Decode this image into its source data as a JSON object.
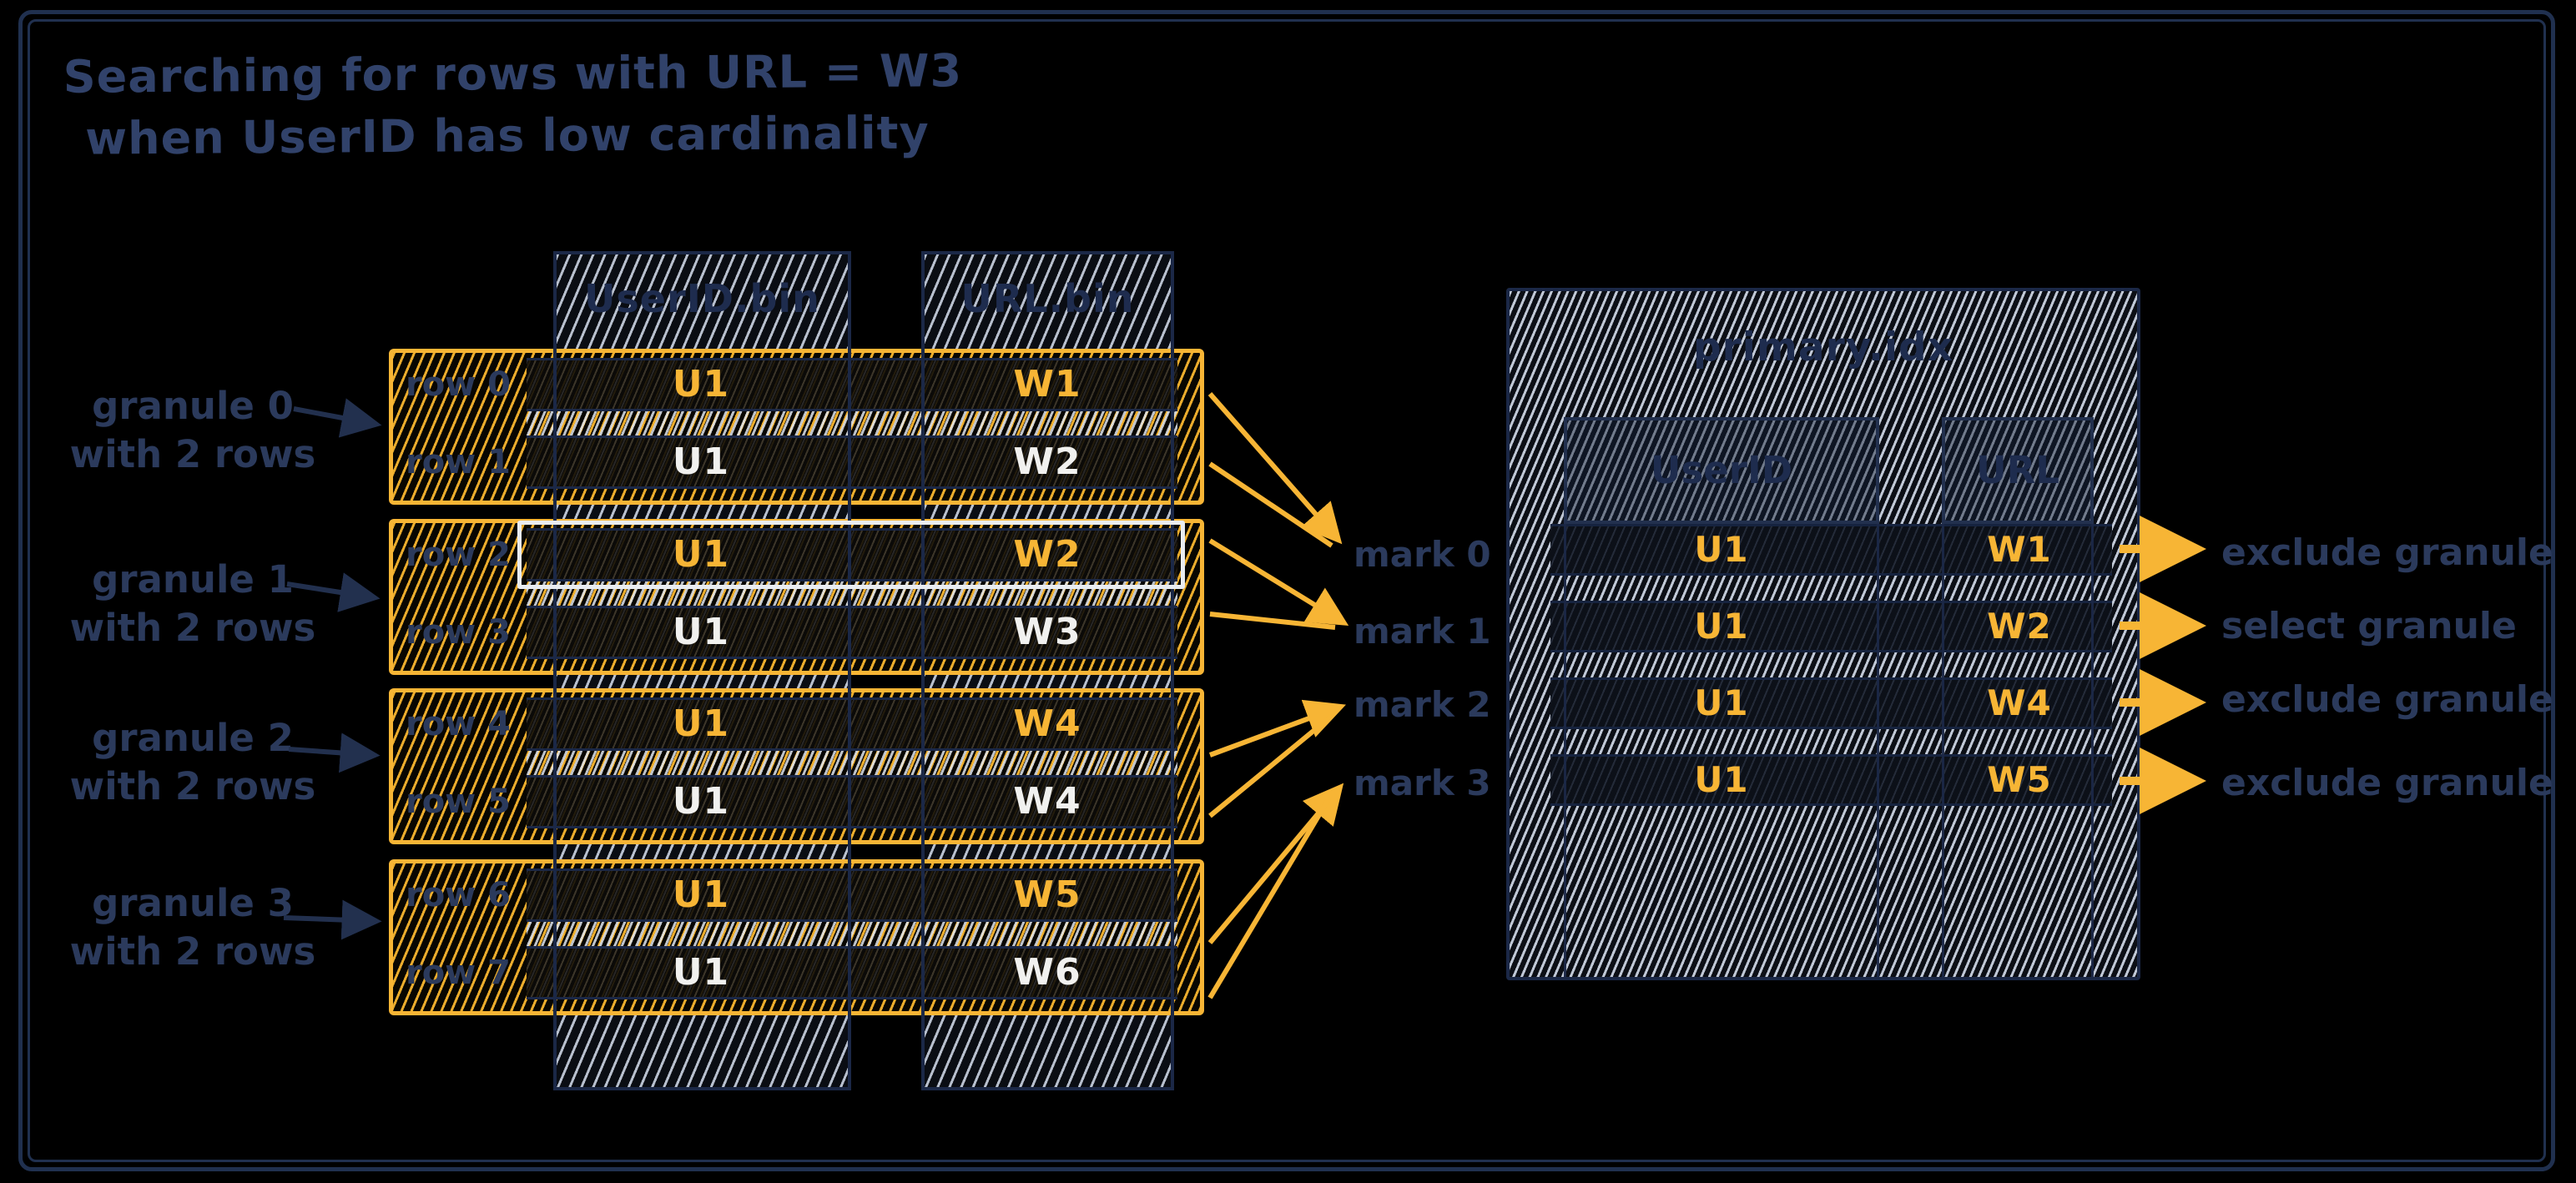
{
  "title": {
    "line1": "Searching for rows with URL = W3",
    "line2": "when UserID has low cardinality"
  },
  "colors": {
    "background": "#000000",
    "ink_navy": "#22304e",
    "accent_orange": "#f7b535",
    "highlight_white": "#e9ecf1",
    "hatch_light": "#cbd3e2"
  },
  "column_files": {
    "userid_header": "UserID.bin",
    "url_header": "URL.bin"
  },
  "granules": [
    {
      "label": [
        "granule 0",
        "with 2 rows"
      ],
      "rows": [
        {
          "row_label": "row 0",
          "userid": "U1",
          "url": "W1"
        },
        {
          "row_label": "row 1",
          "userid": "U1",
          "url": "W2"
        }
      ]
    },
    {
      "label": [
        "granule 1",
        "with 2 rows"
      ],
      "rows": [
        {
          "row_label": "row 2",
          "userid": "U1",
          "url": "W2",
          "highlighted": true
        },
        {
          "row_label": "row 3",
          "userid": "U1",
          "url": "W3"
        }
      ]
    },
    {
      "label": [
        "granule 2",
        "with 2 rows"
      ],
      "rows": [
        {
          "row_label": "row 4",
          "userid": "U1",
          "url": "W4"
        },
        {
          "row_label": "row 5",
          "userid": "U1",
          "url": "W4"
        }
      ]
    },
    {
      "label": [
        "granule 3",
        "with 2 rows"
      ],
      "rows": [
        {
          "row_label": "row 6",
          "userid": "U1",
          "url": "W5"
        },
        {
          "row_label": "row 7",
          "userid": "U1",
          "url": "W6"
        }
      ]
    }
  ],
  "marks": [
    "mark 0",
    "mark 1",
    "mark 2",
    "mark 3"
  ],
  "primary_index": {
    "file_title": "primary.idx",
    "userid_header": "UserID",
    "url_header": "URL",
    "entries": [
      {
        "userid": "U1",
        "url": "W1",
        "decision": "exclude granule"
      },
      {
        "userid": "U1",
        "url": "W2",
        "decision": "select granule"
      },
      {
        "userid": "U1",
        "url": "W4",
        "decision": "exclude granule"
      },
      {
        "userid": "U1",
        "url": "W5",
        "decision": "exclude granule"
      }
    ]
  }
}
